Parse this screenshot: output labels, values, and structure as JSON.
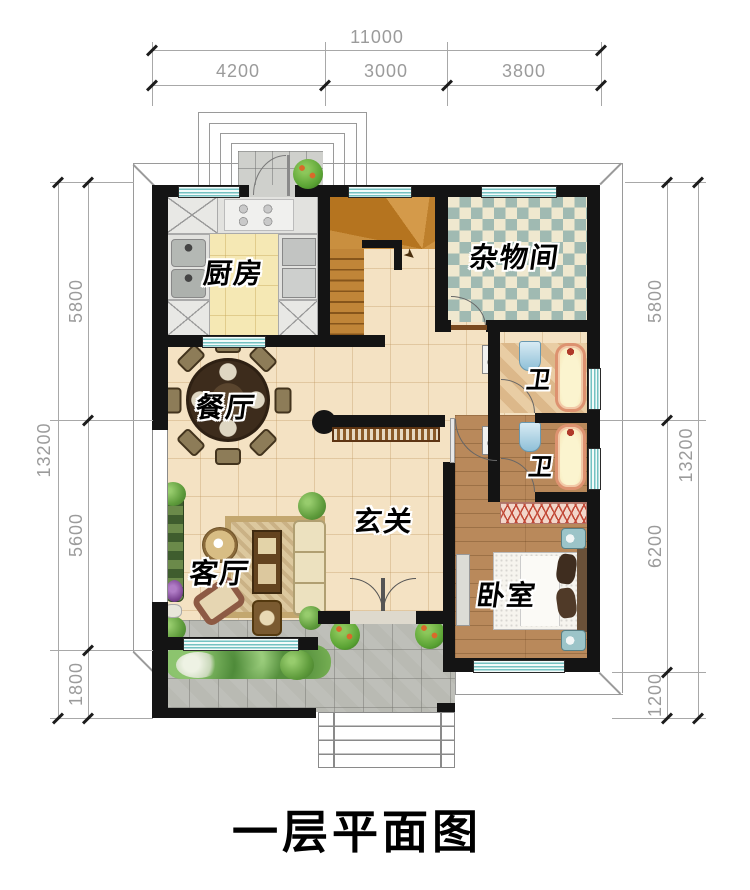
{
  "title": "一层平面图",
  "rooms": {
    "kitchen": "厨房",
    "storage": "杂物间",
    "dining": "餐厅",
    "foyer": "玄关",
    "living": "客厅",
    "bedroom": "卧室",
    "bath_upper": "卫",
    "bath_lower": "卫"
  },
  "dimensions": {
    "top": {
      "total": "11000",
      "segments": [
        "4200",
        "3000",
        "3800"
      ]
    },
    "left": {
      "total": "13200",
      "segments": [
        "5800",
        "5600",
        "1800"
      ]
    },
    "right": {
      "total": "13200",
      "segments": [
        "5800",
        "6200",
        "1200"
      ]
    }
  },
  "icons": {
    "stair_arrow": "➤"
  },
  "colors": {
    "wall": "#141414",
    "floor_main": "#f4e2c3",
    "floor_kitchen": "#f5e8b4",
    "checker_teal": "#a0bab2",
    "checker_cream": "#efe8cf",
    "stair_wood": "#c08538",
    "bedroom_wood": "#b9895b",
    "window_teal": "#74c2c2",
    "terrace_gray": "#b9bab3",
    "tub_rim": "#dd9270",
    "dim_text": "#9b9b9b"
  }
}
